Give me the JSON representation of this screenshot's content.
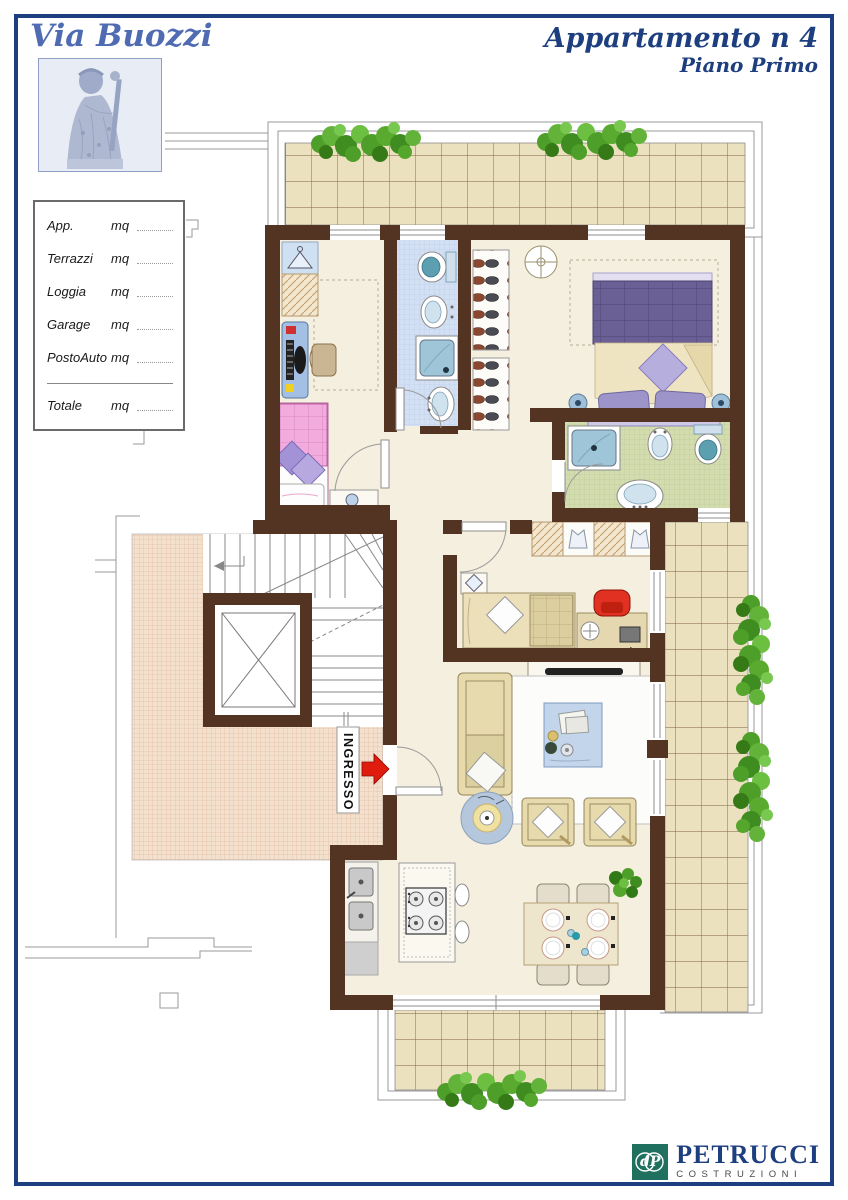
{
  "header": {
    "street_label": "Via Buozzi",
    "title": "Appartamento n 4",
    "subtitle": "Piano Primo"
  },
  "measurements": {
    "rows": [
      {
        "label": "App.",
        "unit": "mq",
        "value": ""
      },
      {
        "label": "Terrazzi",
        "unit": "mq",
        "value": ""
      },
      {
        "label": "Loggia",
        "unit": "mq",
        "value": ""
      },
      {
        "label": "Garage",
        "unit": "mq",
        "value": ""
      },
      {
        "label": "PostoAuto",
        "unit": "mq",
        "value": ""
      }
    ],
    "total": {
      "label": "Totale",
      "unit": "mq",
      "value": ""
    }
  },
  "plan": {
    "entrance_label": "INGRESSO"
  },
  "footer": {
    "brand": "PETRUCCI",
    "brand_sub": "COSTRUZIONI",
    "monogram": "dP"
  },
  "colors": {
    "border_blue": "#1d3f7f",
    "title_blue": "#1d3f7f",
    "script_blue": "#4f6cb3",
    "wall_brown": "#533321",
    "floor_cream": "#f5efdf",
    "terrace_tile": "#ebe1bf",
    "bath_blue": "#d3e0f4",
    "bath_green": "#d3dcae",
    "landing_pink": "#f3e0cd",
    "accent_red": "#e01c0f",
    "plant_green": "#4e9e2a",
    "logo_teal": "#20705f",
    "outline_gray": "#9a9a9a"
  }
}
